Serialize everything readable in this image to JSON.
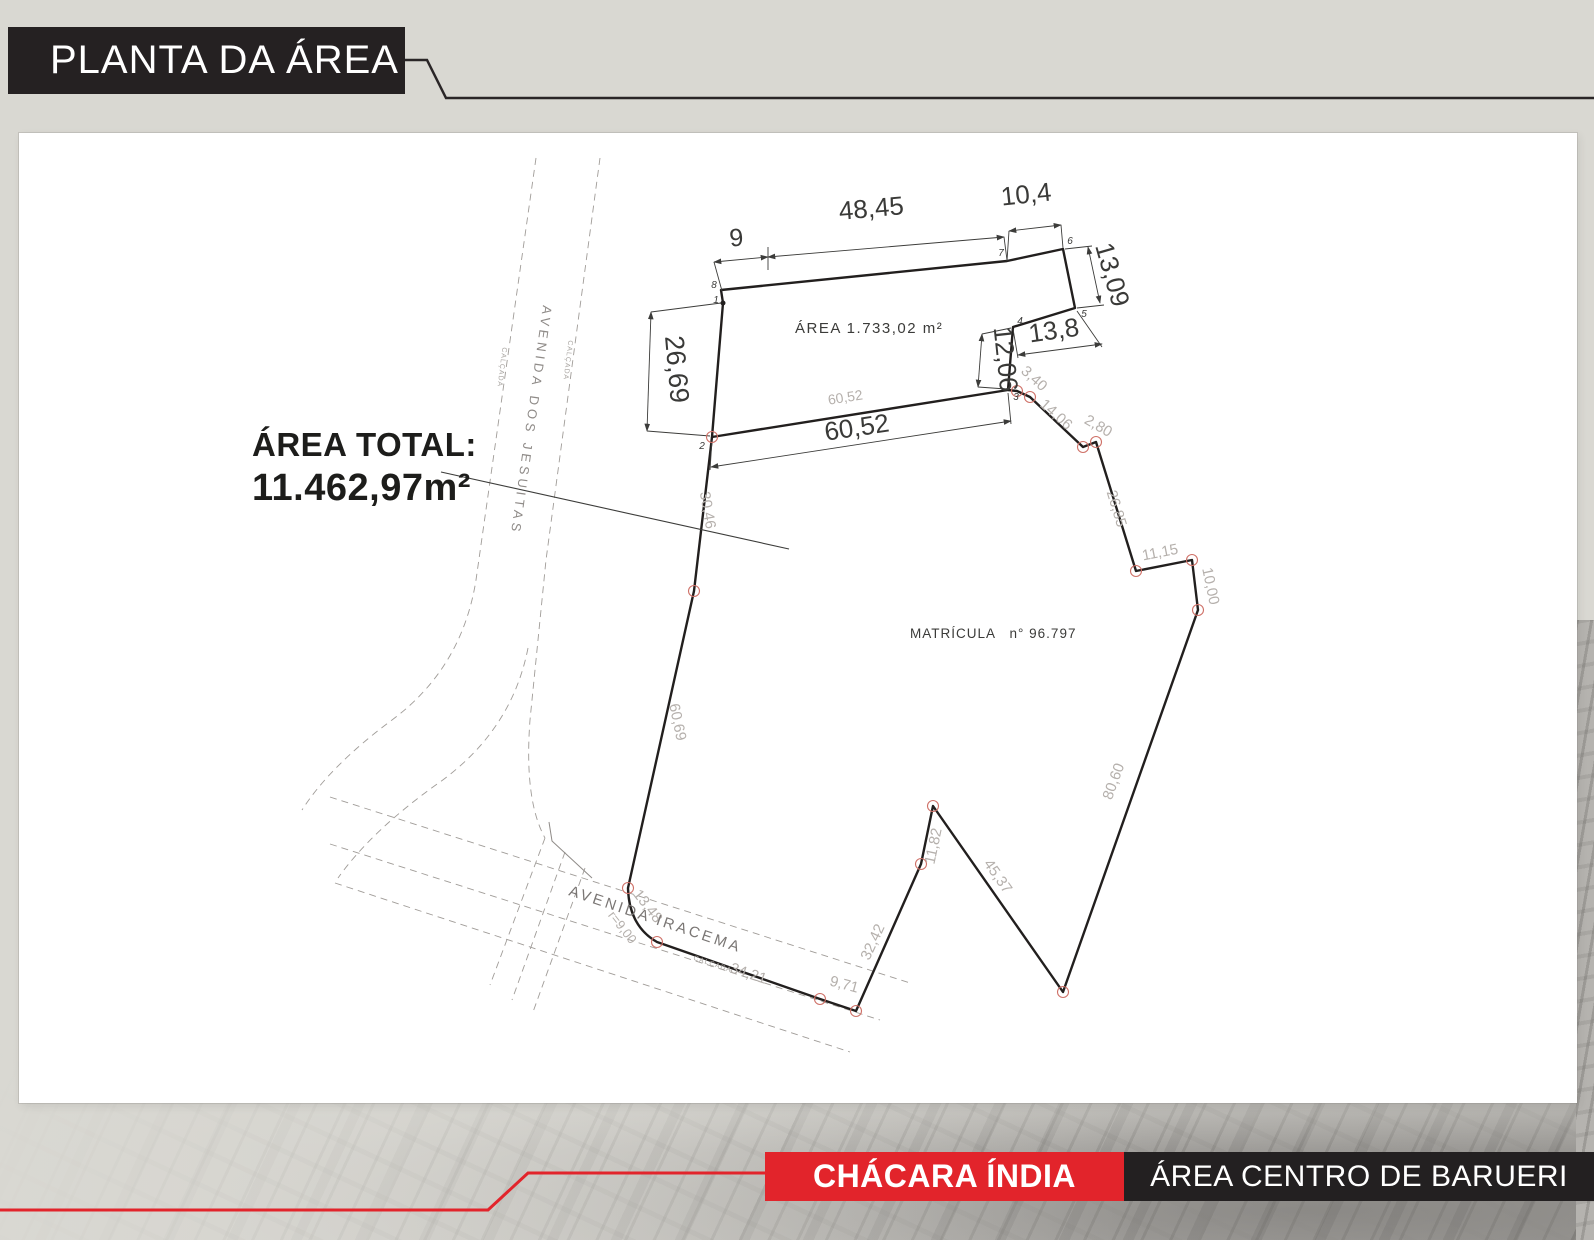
{
  "header": {
    "title": "PLANTA DA ÁREA"
  },
  "footer": {
    "project_name": "CHÁCARA ÍNDIA",
    "location": "ÁREA CENTRO DE BARUERI",
    "accent_red": "#e2242b"
  },
  "summary": {
    "total_area_title": "ÁREA TOTAL:",
    "total_area_value": "11.462,97m²"
  },
  "plan": {
    "parcel_area_label": "ÁREA 1.733,02 m²",
    "registry_label": "MATRÍCULA   n° 96.797",
    "street_jesuitas": "AVENIDA DOS JESUITAS",
    "street_iracema": "AVENIDA IRACEMA",
    "sidewalk": "CALÇADA",
    "dimensions": {
      "d9": "9",
      "d48_45": "48,45",
      "d10_4": "10,4",
      "d13_09": "13,09",
      "d13_8": "13,8",
      "d12_06": "12,06",
      "d26_69": "26,69",
      "d60_52": "60,52"
    },
    "edges": {
      "e60_52": "60,52",
      "e30_46": "30,46",
      "e60_69": "60,69",
      "e13_48": "13,48",
      "er9": "r=9,00",
      "e34_21": "34,21",
      "e9_71": "9,71",
      "e32_42": "32,42",
      "e11_82": "11,82",
      "e45_37": "45,37",
      "e80_60": "80,60",
      "e10_00": "10,00",
      "e11_15": "11,15",
      "e26_85": "26,85",
      "e2_80": "2,80",
      "e14_06": "14,06",
      "e3_40": "3,40"
    },
    "vertices": {
      "v1": "1",
      "v2": "2",
      "v3": "3",
      "v4": "4",
      "v5": "5",
      "v6": "6",
      "v7": "7",
      "v8": "8"
    },
    "colors": {
      "boundary": "#221f1e",
      "dimension": "#3c3c3a",
      "edge_label": "#b5b0ac",
      "road": "#a09c98",
      "vertex_marker": "#cf7168"
    }
  }
}
